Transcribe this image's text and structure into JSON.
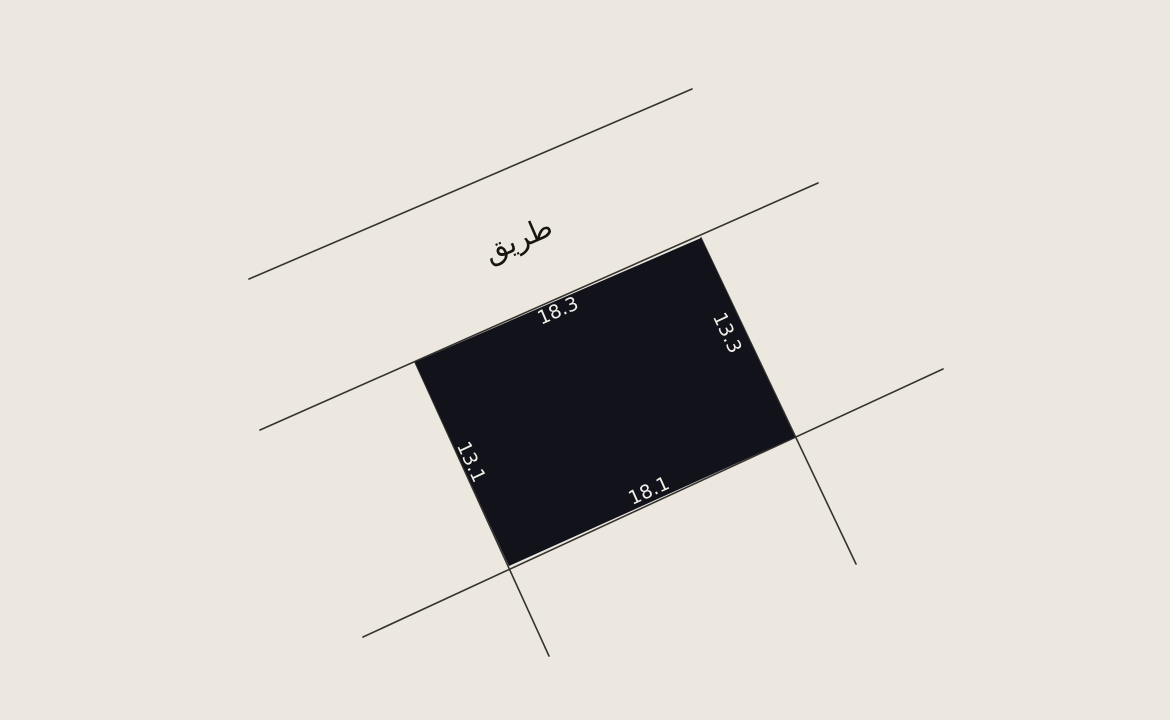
{
  "colors": {
    "background": "#ECE8E0",
    "parcel_fill": "#12121B",
    "boundary_line": "#35332F",
    "dimension_text": "#F1EEE8",
    "road_text": "#17150F"
  },
  "road": {
    "label": "طريق"
  },
  "parcel": {
    "dimensions": {
      "north": "18.3",
      "east": "13.3",
      "south": "18.1",
      "west": "13.1"
    }
  }
}
